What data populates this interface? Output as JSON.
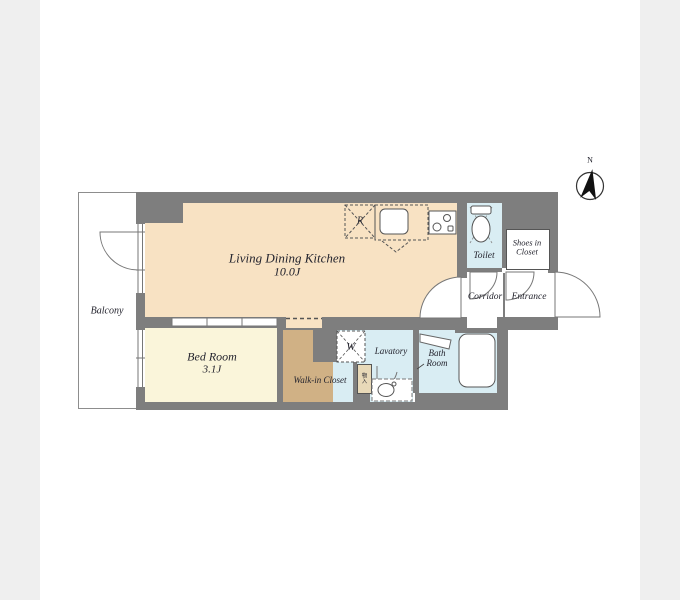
{
  "plan": {
    "compass": {
      "north_label": "N"
    },
    "rooms": {
      "balcony": {
        "label": "Balcony"
      },
      "ldk": {
        "label": "Living Dining Kitchen",
        "size": "10.0J"
      },
      "bedroom": {
        "label": "Bed Room",
        "size": "3.1J"
      },
      "walk_in_closet": {
        "label": "Walk-in Closet"
      },
      "lavatory": {
        "label": "Lavatory"
      },
      "bath": {
        "label_line1": "Bath",
        "label_line2": "Room"
      },
      "toilet": {
        "label": "Toilet"
      },
      "shoes_closet": {
        "label_line1": "Shoes in",
        "label_line2": "Closet"
      },
      "corridor": {
        "label": "Corridor"
      },
      "entrance": {
        "label": "Entrance"
      }
    },
    "fixtures": {
      "refrigerator_mark": "R",
      "washer_mark": "W",
      "storage_mark": "物入"
    },
    "colors": {
      "wall": "#7e7e7e",
      "ldk_floor": "#f8e2c3",
      "bedroom_floor": "#faf5da",
      "closet_floor": "#d0b185",
      "wet_area_floor": "#d9edf3",
      "margin_bars": "#efefef"
    }
  }
}
